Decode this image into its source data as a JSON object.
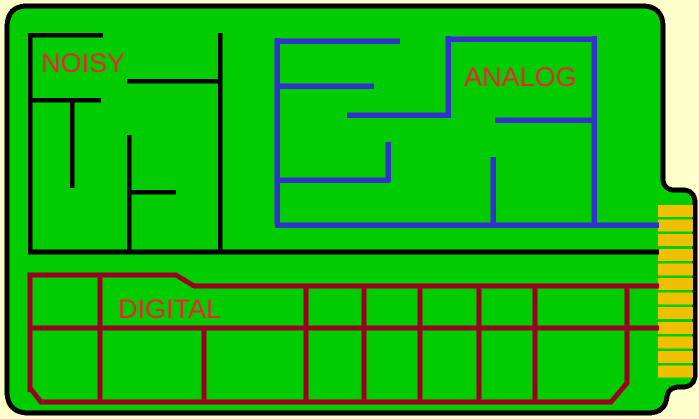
{
  "diagram": {
    "kind": "pcb-partitioning-diagram",
    "board": {
      "color": "board-green",
      "outline_color": "black",
      "shape": "rounded-rectangle-with-edge-connector-tab"
    },
    "regions": [
      {
        "id": "noisy",
        "label": "NOISY",
        "trace_color_name": "black"
      },
      {
        "id": "analog",
        "label": "ANALOG",
        "trace_color_name": "blue"
      },
      {
        "id": "digital",
        "label": "DIGITAL",
        "trace_color_name": "dark-red"
      }
    ],
    "edge_connector": {
      "finger_count": 12,
      "finger_color_name": "gold",
      "geometry": {
        "x": 658,
        "width": 35,
        "first_y": 205,
        "height": 12,
        "pitch": 14.6
      }
    }
  },
  "colors": {
    "background": "#FFFFCC",
    "board": "#00CC00",
    "outline": "#000000",
    "noisy_traces": "#000000",
    "analog_traces": "#3333CC",
    "digital_traces": "#990022",
    "label_text": "#EE2233",
    "connector_fingers": "#EEC000"
  }
}
